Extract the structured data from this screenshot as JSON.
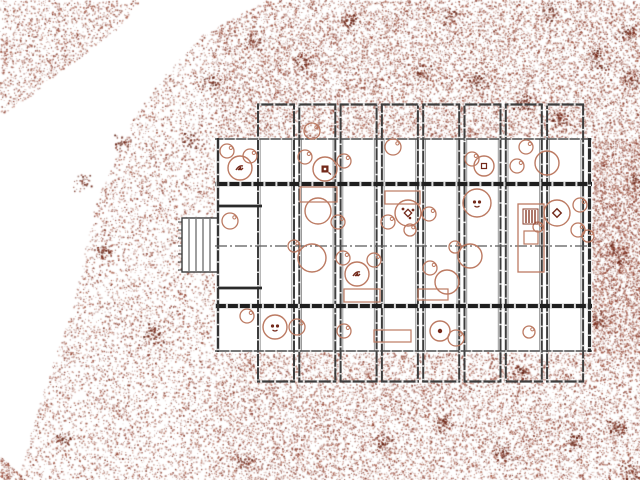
{
  "meta": {
    "width": 640,
    "height": 480,
    "background": "#ffffff",
    "drawing_type": "architectural site plan"
  },
  "palette": {
    "terrain_dots": [
      "#9a4936",
      "#87382a",
      "#7b2d1c",
      "#a65a45"
    ],
    "clump_dots": [
      "#6b2415",
      "#5f1f10",
      "#7b2d1c"
    ],
    "star": "#7b3322",
    "furniture": "#bc7a62",
    "furniture_dark": "#73291a",
    "tree_outline": "#a65a45",
    "wall_dark": "#1f1f1f",
    "wall_mid": "#3d3d3d",
    "wall_light": "#4a4a4a",
    "wall_gray": "#9a9a9a",
    "bars": "#5f1f10",
    "bike": "#8a3c28",
    "marker": "#6b2415",
    "white": "#ffffff"
  },
  "terrain": {
    "seed": 1337,
    "exclusion_rect": [
      215,
      138,
      377,
      214
    ],
    "regions": {
      "main": {
        "count": 24000,
        "points": [
          [
            265,
            0
          ],
          [
            640,
            0
          ],
          [
            640,
            480
          ],
          [
            26,
            480
          ],
          [
            20,
            470
          ],
          [
            40,
            400
          ],
          [
            58,
            348
          ],
          [
            72,
            310
          ],
          [
            85,
            248
          ],
          [
            93,
            213
          ],
          [
            104,
            180
          ],
          [
            113,
            163
          ],
          [
            133,
            118
          ],
          [
            160,
            80
          ],
          [
            200,
            36
          ],
          [
            265,
            0
          ]
        ]
      },
      "corner_tl": {
        "count": 1600,
        "points": [
          [
            0,
            0
          ],
          [
            140,
            0
          ],
          [
            118,
            28
          ],
          [
            60,
            72
          ],
          [
            30,
            96
          ],
          [
            0,
            115
          ]
        ]
      },
      "corner_bl": {
        "count": 150,
        "points": [
          [
            0,
            456
          ],
          [
            26,
            480
          ],
          [
            0,
            480
          ]
        ]
      }
    },
    "dense_zones": [
      [
        215,
        0,
        425,
        138,
        5200
      ],
      [
        592,
        138,
        48,
        214,
        2600
      ],
      [
        215,
        352,
        425,
        128,
        3800
      ]
    ],
    "clumps": [
      [
        598,
        58,
        14,
        60
      ],
      [
        560,
        118,
        12,
        50
      ],
      [
        618,
        255,
        13,
        55
      ],
      [
        595,
        318,
        12,
        45
      ],
      [
        478,
        82,
        12,
        45
      ],
      [
        522,
        102,
        10,
        40
      ],
      [
        302,
        62,
        11,
        40
      ],
      [
        252,
        42,
        10,
        35
      ],
      [
        422,
        72,
        10,
        35
      ],
      [
        618,
        428,
        13,
        55
      ],
      [
        630,
        472,
        12,
        50
      ],
      [
        502,
        452,
        12,
        45
      ],
      [
        382,
        442,
        11,
        40
      ],
      [
        152,
        332,
        12,
        45
      ],
      [
        102,
        252,
        10,
        40
      ],
      [
        82,
        182,
        10,
        35
      ],
      [
        202,
        232,
        10,
        35
      ],
      [
        122,
        142,
        10,
        35
      ],
      [
        232,
        302,
        10,
        35
      ],
      [
        522,
        372,
        10,
        40
      ],
      [
        442,
        422,
        10,
        35
      ],
      [
        62,
        438,
        10,
        40
      ],
      [
        572,
        442,
        10,
        40
      ],
      [
        245,
        462,
        10,
        35
      ],
      [
        350,
        20,
        10,
        35
      ],
      [
        450,
        15,
        10,
        30
      ],
      [
        550,
        12,
        10,
        30
      ],
      [
        628,
        32,
        11,
        45
      ],
      [
        630,
        80,
        12,
        45
      ],
      [
        636,
        180,
        10,
        40
      ],
      [
        210,
        80,
        10,
        35
      ],
      [
        190,
        140,
        9,
        30
      ]
    ]
  },
  "building": {
    "body": [
      215,
      138,
      377,
      214
    ],
    "bays": {
      "count": 8,
      "first_left": 258,
      "pitch": 41.3,
      "width": 36,
      "top_y": 104,
      "bottom_y": 382,
      "body_top": 138,
      "body_bottom": 352
    },
    "heavy_walls_y": [
      184,
      306
    ],
    "center_line_y": 246,
    "left_room_walls": {
      "y": [
        206,
        288
      ],
      "x1": 218,
      "x2": 262
    },
    "deck": {
      "rect": [
        182,
        218,
        36,
        54
      ],
      "slats_x": [
        189,
        196,
        203,
        210
      ]
    }
  },
  "furniture": {
    "tables": [
      [
        240,
        168,
        12,
        "plant"
      ],
      [
        325,
        169,
        12,
        "block"
      ],
      [
        484,
        166,
        10,
        "smallsq"
      ],
      [
        547,
        163,
        12,
        ""
      ],
      [
        318,
        211,
        13,
        ""
      ],
      [
        408,
        213,
        13,
        "diamond-dots"
      ],
      [
        477,
        203,
        14,
        "dots2"
      ],
      [
        557,
        213,
        13,
        "diamond"
      ],
      [
        312,
        258,
        14,
        ""
      ],
      [
        357,
        274,
        12,
        "plant"
      ],
      [
        470,
        256,
        12,
        ""
      ],
      [
        447,
        282,
        12,
        ""
      ],
      [
        275,
        327,
        12,
        "dots2"
      ],
      [
        440,
        331,
        10,
        "dot"
      ]
    ],
    "chairs": [
      [
        227,
        151,
        7
      ],
      [
        250,
        156,
        7
      ],
      [
        305,
        157,
        7
      ],
      [
        312,
        131,
        8
      ],
      [
        344,
        161,
        7
      ],
      [
        393,
        147,
        8
      ],
      [
        472,
        159,
        7
      ],
      [
        517,
        166,
        7
      ],
      [
        526,
        147,
        7
      ],
      [
        230,
        221,
        8
      ],
      [
        338,
        222,
        7
      ],
      [
        388,
        222,
        7
      ],
      [
        429,
        214,
        7
      ],
      [
        410,
        230,
        6
      ],
      [
        580,
        205,
        7
      ],
      [
        578,
        230,
        7
      ],
      [
        538,
        227,
        5
      ],
      [
        588,
        236,
        6
      ],
      [
        294,
        246,
        6
      ],
      [
        343,
        258,
        7
      ],
      [
        374,
        260,
        7
      ],
      [
        455,
        247,
        6
      ],
      [
        430,
        268,
        7
      ],
      [
        247,
        316,
        7
      ],
      [
        297,
        327,
        8
      ],
      [
        344,
        331,
        7
      ],
      [
        456,
        338,
        8
      ],
      [
        529,
        332,
        6
      ]
    ],
    "rects": [
      [
        300,
        187,
        37,
        15
      ],
      [
        385,
        191,
        35,
        13
      ],
      [
        344,
        289,
        36,
        13
      ],
      [
        418,
        289,
        30,
        11
      ],
      [
        374,
        330,
        37,
        12
      ]
    ],
    "wc_unit": {
      "box": [
        518,
        204,
        26,
        68
      ],
      "hatch": [
        523,
        209,
        15,
        15
      ],
      "sink": [
        524,
        231,
        14,
        13
      ],
      "basin": [
        531,
        262,
        7
      ]
    },
    "ladder": {
      "box": [
        568,
        189,
        17,
        112
      ],
      "rungs": 6
    }
  },
  "site": {
    "stars": [
      [
        55,
        75,
        16
      ],
      [
        313,
        13,
        18
      ],
      [
        593,
        30,
        12
      ],
      [
        597,
        50,
        15
      ],
      [
        541,
        66,
        9
      ],
      [
        601,
        186,
        13
      ],
      [
        213,
        113,
        13
      ],
      [
        173,
        178,
        17
      ],
      [
        95,
        290,
        11
      ],
      [
        137,
        296,
        12
      ],
      [
        232,
        378,
        14
      ],
      [
        531,
        417,
        12
      ],
      [
        557,
        417,
        13
      ],
      [
        624,
        372,
        11
      ],
      [
        33,
        34,
        9
      ]
    ],
    "circle_trees": [
      [
        311,
        91,
        8
      ],
      [
        371,
        88,
        8
      ],
      [
        428,
        40,
        8
      ],
      [
        463,
        46,
        8
      ],
      [
        408,
        108,
        8
      ],
      [
        602,
        152,
        10
      ],
      [
        617,
        167,
        8
      ],
      [
        610,
        326,
        8
      ],
      [
        360,
        343,
        11
      ],
      [
        408,
        382,
        9
      ],
      [
        342,
        405,
        8
      ],
      [
        357,
        419,
        8
      ]
    ],
    "bicycles": [
      [
        146,
        403,
        -25
      ]
    ],
    "triangles": [
      [
        168,
        244,
        9
      ],
      [
        60,
        242,
        7
      ]
    ],
    "edge_bars": [
      [
        3,
        0,
        3,
        13
      ],
      [
        9,
        0,
        2.5,
        14
      ],
      [
        15,
        0,
        2.5,
        11
      ],
      [
        33,
        0,
        2.5,
        9
      ],
      [
        39,
        0,
        2.5,
        10
      ],
      [
        45,
        0,
        2,
        7
      ]
    ],
    "marker": {
      "x": 240,
      "y": 351
    },
    "scribble": {
      "x": 5,
      "y": 278
    }
  }
}
